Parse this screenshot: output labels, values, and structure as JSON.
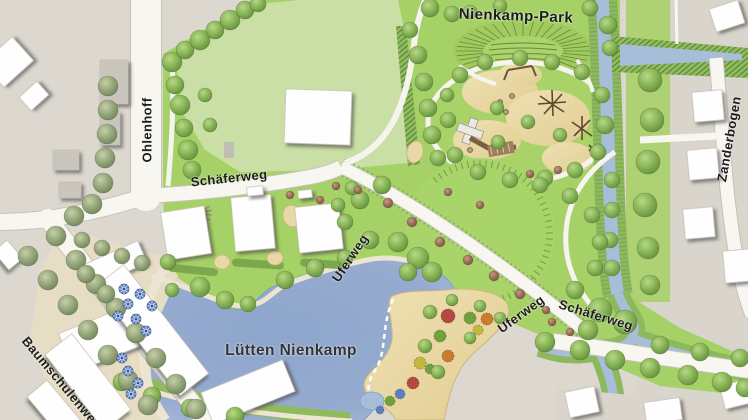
{
  "map": {
    "region_title": "Nienkamp-Park",
    "lake_label": "Lütten Nienkamp",
    "street_labels": {
      "ohlenhoff": "Ohlenhoff",
      "schaeferweg_west": "Schäferweg",
      "schaeferweg_east": "Schäferweg",
      "uferweg_upper": "Uferweg",
      "uferweg_lower": "Uferweg",
      "zanderbogen": "Zanderbogen",
      "baumschulenweg": "Baumschulenweg"
    },
    "feature_names": [
      "park-lawn",
      "amphitheatre",
      "playground",
      "event-lawn",
      "lake",
      "beach",
      "stream",
      "plaza-with-parasols",
      "residential-buildings",
      "tree-lined-streets"
    ],
    "colors": {
      "park_green": "#a6d166",
      "meadow_green": "#cadfa6",
      "canopy_green": "#74a04c",
      "lake_blue": "#93a9cf",
      "stream_blue": "#a8bdd8",
      "sand_beige": "#ecdcae",
      "plaza_beige": "#e7ddc4",
      "urban_grey": "#dcd8d0",
      "road_white": "#f8f6f1",
      "bank_green": "#86b356",
      "parasol_blue": "#5b7fc0",
      "building_white": "#ffffff",
      "label_dark": "#1c1c1c"
    }
  }
}
